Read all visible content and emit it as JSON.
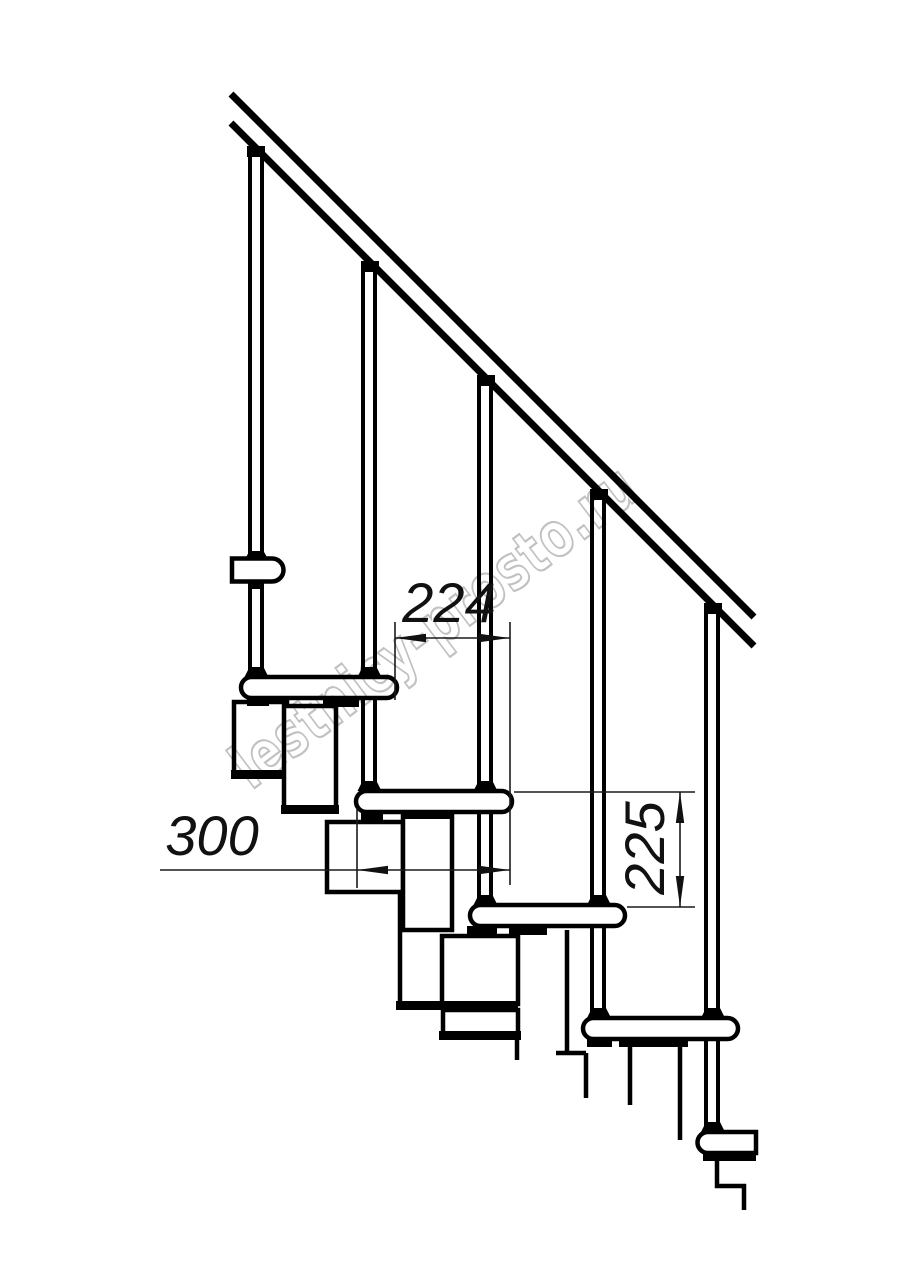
{
  "drawing": {
    "watermark": "lestnicy-prosto.ru",
    "dimensions": {
      "going": "224",
      "tread_depth": "300",
      "rise": "225"
    },
    "colors": {
      "line": "#000000",
      "watermark": "#bababa",
      "background": "#ffffff"
    }
  }
}
